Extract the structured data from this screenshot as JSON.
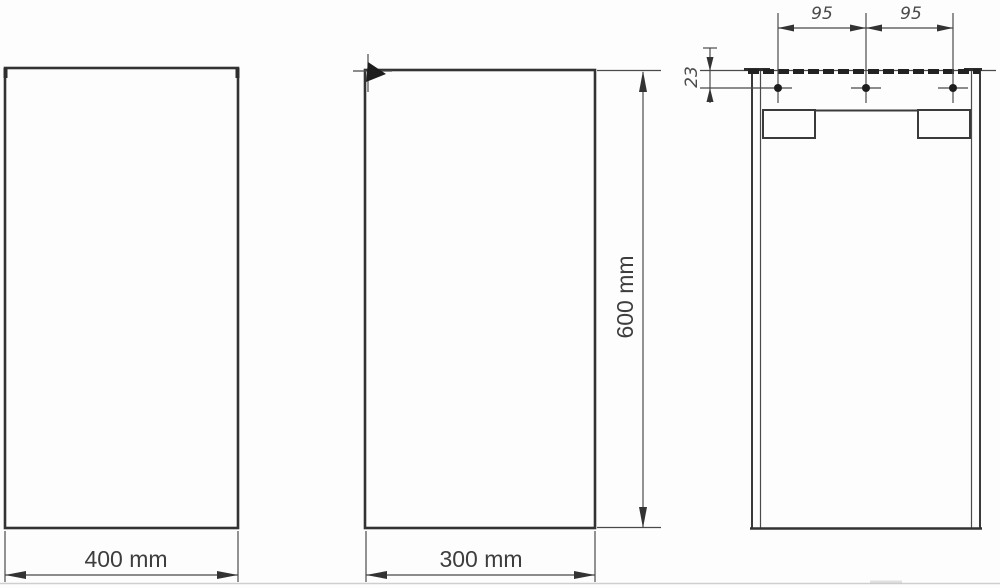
{
  "drawing": {
    "kind": "technical dimensional drawing",
    "subject": "wall cabinet, three orthographic views (front, side, rear mounting detail)",
    "colors": {
      "line": "#3a3a3a",
      "text": "#3d3d3d",
      "background": "#fdfdfd",
      "footer_rule": "#cfcfcf"
    },
    "views": {
      "front": {
        "name": "front-view",
        "width_label": "400 mm"
      },
      "side": {
        "name": "side-view",
        "depth_label": "300 mm",
        "height_label": "600 mm"
      },
      "back": {
        "name": "rear-mounting-view",
        "mounting_hole_count": "3",
        "hole_spacing_left": "95",
        "hole_spacing_right": "95",
        "hole_top_offset": "23"
      }
    }
  }
}
